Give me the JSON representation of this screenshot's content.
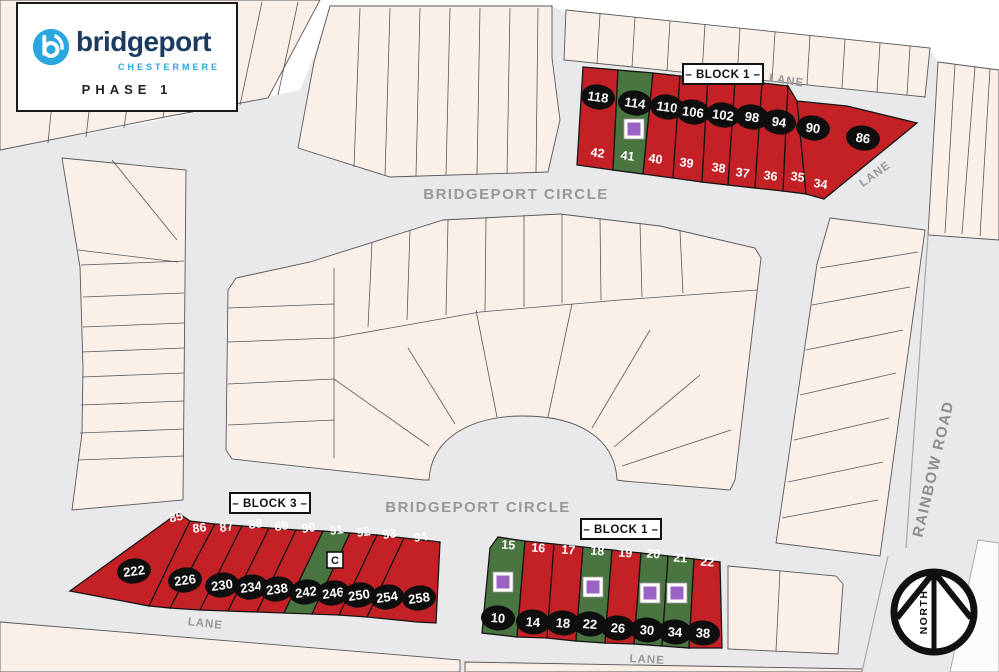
{
  "logo": {
    "brand": "bridgeport",
    "city": "CHESTERMERE",
    "phase": "PHASE 1"
  },
  "road_labels": {
    "circle_top": "BRIDGEPORT CIRCLE",
    "circle_bottom": "BRIDGEPORT CIRCLE",
    "rainbow_road": "RAINBOW ROAD",
    "lane_ne": "LANE",
    "lane_e": "LANE",
    "lane_sw": "LANE",
    "lane_s": "LANE"
  },
  "north_label": "NORTH",
  "colors": {
    "lot_red": "#c42127",
    "lot_green": "#4a7440",
    "marker_purple": "#9a63c4",
    "oval_black": "#0e0e0e",
    "beige": "#faf0e8",
    "road_gray": "#e9e9eb",
    "outline_gray": "#56575b",
    "road_text_gray": "#98989a"
  },
  "blocks": [
    {
      "label": "– BLOCK 1 –",
      "lots": [
        {
          "lot": "42",
          "address": "118",
          "color": "red",
          "marker": null
        },
        {
          "lot": "41",
          "address": "114",
          "color": "green",
          "marker": "square"
        },
        {
          "lot": "40",
          "address": "110",
          "color": "red",
          "marker": null
        },
        {
          "lot": "39",
          "address": "106",
          "color": "red",
          "marker": null
        },
        {
          "lot": "38",
          "address": "102",
          "color": "red",
          "marker": null
        },
        {
          "lot": "37",
          "address": "98",
          "color": "red",
          "marker": null
        },
        {
          "lot": "36",
          "address": "94",
          "color": "red",
          "marker": null
        },
        {
          "lot": "35",
          "address": "90",
          "color": "red",
          "marker": null
        },
        {
          "lot": "34",
          "address": "86",
          "color": "red",
          "marker": null
        }
      ]
    },
    {
      "label": "– BLOCK 3 –",
      "lots": [
        {
          "lot": "85",
          "address": "222",
          "color": "red",
          "marker": null
        },
        {
          "lot": "86",
          "address": "226",
          "color": "red",
          "marker": null
        },
        {
          "lot": "87",
          "address": "230",
          "color": "red",
          "marker": null
        },
        {
          "lot": "88",
          "address": "234",
          "color": "red",
          "marker": null
        },
        {
          "lot": "89",
          "address": "238",
          "color": "red",
          "marker": null
        },
        {
          "lot": "90",
          "address": "242",
          "color": "red",
          "marker": null
        },
        {
          "lot": "91",
          "address": "246",
          "color": "green",
          "marker": "C"
        },
        {
          "lot": "92",
          "address": "250",
          "color": "red",
          "marker": null
        },
        {
          "lot": "93",
          "address": "254",
          "color": "red",
          "marker": null
        },
        {
          "lot": "94",
          "address": "258",
          "color": "red",
          "marker": null
        }
      ]
    },
    {
      "label": "– BLOCK 1 –",
      "lots": [
        {
          "lot": "15",
          "address": "10",
          "color": "green",
          "marker": "square"
        },
        {
          "lot": "16",
          "address": "14",
          "color": "red",
          "marker": null
        },
        {
          "lot": "17",
          "address": "18",
          "color": "red",
          "marker": null
        },
        {
          "lot": "18",
          "address": "22",
          "color": "green",
          "marker": "square"
        },
        {
          "lot": "19",
          "address": "26",
          "color": "red",
          "marker": null
        },
        {
          "lot": "20",
          "address": "30",
          "color": "green",
          "marker": "square"
        },
        {
          "lot": "21",
          "address": "34",
          "color": "green",
          "marker": "square"
        },
        {
          "lot": "22",
          "address": "38",
          "color": "red",
          "marker": null
        }
      ]
    }
  ]
}
